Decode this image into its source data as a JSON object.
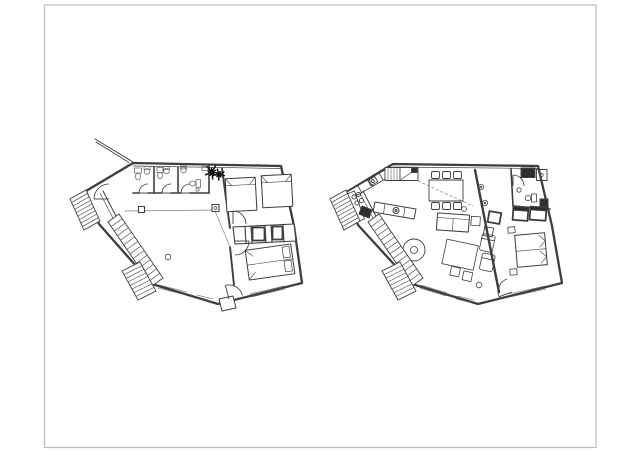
{
  "page": {
    "width": 640,
    "height": 453,
    "background": "#ffffff",
    "frame_color": "#bcbcbc"
  },
  "colors": {
    "line": "#3e3e3e",
    "line_medium": "#6a6a6a",
    "line_light": "#999999",
    "dark_fill": "#2e2e2e",
    "plant": "#111111",
    "white": "#ffffff"
  },
  "drawing": {
    "type": "architectural-floor-plans",
    "plan_count": 2,
    "plans": [
      {
        "id": "left",
        "label": "floor-plan-left",
        "rooms": [
          "bathroom-1",
          "bathroom-2",
          "wc",
          "hall",
          "living-area",
          "bedroom-upper",
          "bedroom-lower"
        ],
        "elements": [
          "exterior-entry-stairs",
          "interior-staircase",
          "railing",
          "beam-with-posts",
          "wardrobe-row",
          "single-bed",
          "single-bed",
          "double-bed",
          "plant",
          "door-swings",
          "windows",
          "entrance-door-leaf"
        ]
      },
      {
        "id": "right",
        "label": "floor-plan-right",
        "rooms": [
          "kitchen",
          "dining-area",
          "living-room",
          "bathroom",
          "bedroom"
        ],
        "elements": [
          "kitchen-counter",
          "cooktop-burners",
          "sink",
          "tall-cabinet",
          "dining-table-six-chairs",
          "island-counter",
          "sofa",
          "side-table",
          "rug",
          "lounge-chairs",
          "round-chair",
          "double-bed",
          "nightstands",
          "wardrobes",
          "shower",
          "interior-staircase",
          "exterior-stairs",
          "door-swings",
          "windows"
        ]
      }
    ]
  },
  "stairs": [
    {
      "plan": "left",
      "x1": 108,
      "y1": 222,
      "x2": 152,
      "y2": 286,
      "ox": 11,
      "oy": -8,
      "steps": 14
    },
    {
      "plan": "left",
      "x1": 70,
      "y1": 199,
      "x2": 84,
      "y2": 230,
      "ox": 16,
      "oy": -9,
      "steps": 9
    },
    {
      "plan": "left",
      "x1": 122,
      "y1": 271,
      "x2": 138,
      "y2": 300,
      "ox": 18,
      "oy": -9,
      "steps": 8
    },
    {
      "plan": "right",
      "x1": 368,
      "y1": 222,
      "x2": 412,
      "y2": 286,
      "ox": 11,
      "oy": -8,
      "steps": 14
    },
    {
      "plan": "right",
      "x1": 330,
      "y1": 199,
      "x2": 344,
      "y2": 230,
      "ox": 16,
      "oy": -9,
      "steps": 9
    },
    {
      "plan": "right",
      "x1": 382,
      "y1": 271,
      "x2": 398,
      "y2": 300,
      "ox": 18,
      "oy": -9,
      "steps": 8
    }
  ],
  "doors": [
    {
      "plan": "left",
      "cx": 109,
      "cy": 199,
      "r": 15,
      "a1": 180,
      "a2": 270
    },
    {
      "plan": "left",
      "cx": 148,
      "cy": 193,
      "r": 9,
      "a1": 180,
      "a2": 270
    },
    {
      "plan": "left",
      "cx": 171,
      "cy": 193,
      "r": 9,
      "a1": 180,
      "a2": 270
    },
    {
      "plan": "left",
      "cx": 190,
      "cy": 193,
      "r": 9,
      "a1": 180,
      "a2": 270
    },
    {
      "plan": "left",
      "cx": 233,
      "cy": 224,
      "r": 13,
      "a1": 270,
      "a2": 360
    },
    {
      "plan": "left",
      "cx": 235,
      "cy": 241,
      "r": 14,
      "a1": 0,
      "a2": 90
    },
    {
      "plan": "left",
      "cx": 229,
      "cy": 299,
      "r": 14,
      "a1": 255,
      "a2": 345
    },
    {
      "plan": "right",
      "cx": 513,
      "cy": 186,
      "r": 11,
      "a1": 270,
      "a2": 360
    },
    {
      "plan": "right",
      "cx": 512,
      "cy": 292,
      "r": 14,
      "a1": 160,
      "a2": 250
    }
  ],
  "plants": [
    {
      "cx": 212,
      "cy": 172,
      "r": 7,
      "spokes": 10
    },
    {
      "cx": 219,
      "cy": 174.5,
      "r": 5.5,
      "spokes": 9
    }
  ]
}
